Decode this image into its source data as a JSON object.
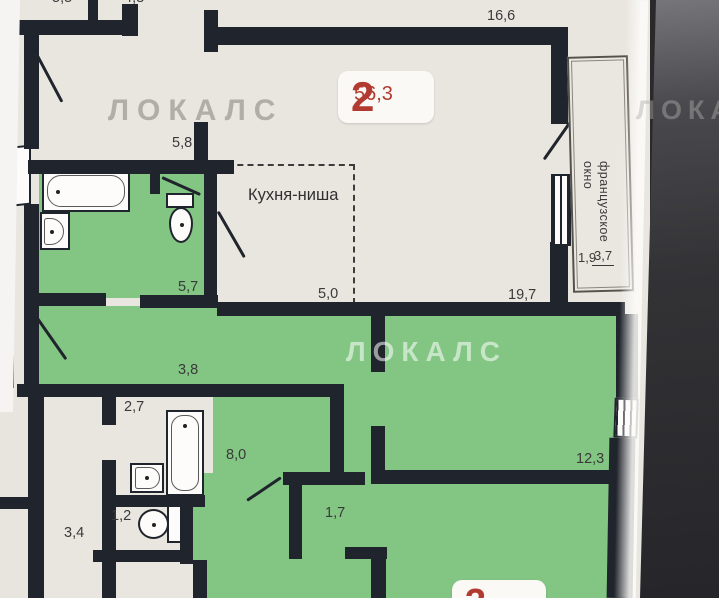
{
  "watermark": {
    "text": "ЛОКАЛС"
  },
  "apartment_badge": {
    "number": "2",
    "area": "56,3"
  },
  "bottom_badge": {
    "number": "3"
  },
  "labels": {
    "top_partial_left": "5,5",
    "top_partial_right": "4,8",
    "top_room_area": "16,6",
    "hallway_top_area": "5,8",
    "kitchen_niche": "Кухня-ниша",
    "kitchen_area": "5,0",
    "living_area": "19,7",
    "bathroom_top_area": "5,7",
    "french_window_line1": "французское",
    "french_window_line2": "окно",
    "balcony_area_full": "3,7",
    "balcony_area_reduced": "1,9",
    "hall_area": "3,8",
    "bathroom2_area": "2,7",
    "corridor_area": "8,0",
    "room_right_area": "12,3",
    "wc_area": "1,2",
    "hall2_area": "3,4",
    "closet_area": "1,7"
  },
  "colors": {
    "accent_red": "#b23b31",
    "room_green": "#83c583",
    "wall": "#20242c",
    "paper": "#e9e6e0",
    "background_dark": "#333336"
  }
}
